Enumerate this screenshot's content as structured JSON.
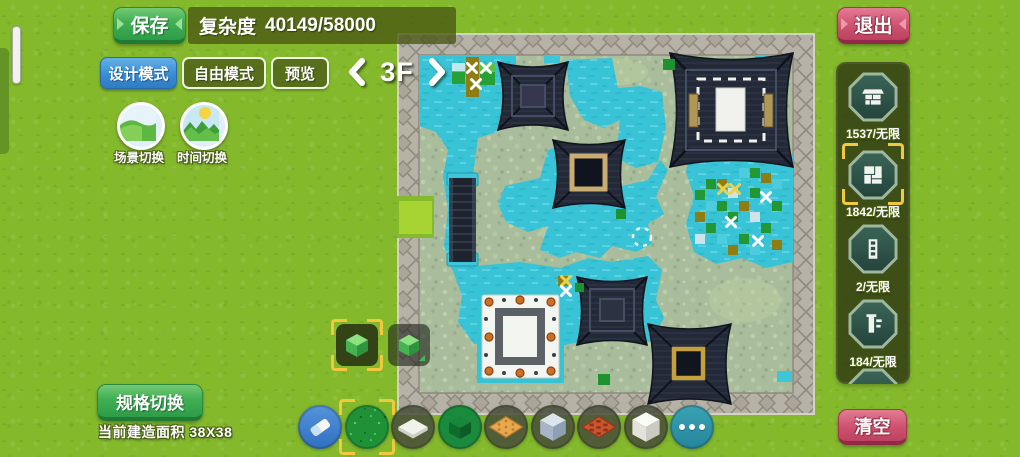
{
  "top_bar": {
    "save_label": "保存",
    "complexity_label": "复杂度",
    "complexity_value": "40149/58000",
    "design_mode_label": "设计模式",
    "free_mode_label": "自由模式",
    "preview_label": "预览",
    "exit_label": "退出"
  },
  "floor_selector": {
    "floor_label": "3F"
  },
  "left_controls": {
    "scene_switch_label": "场景切换",
    "time_switch_label": "时间切换"
  },
  "resource_panel": {
    "items": [
      {
        "icon": "brick-block-icon",
        "count": "1537/无限",
        "selected": false
      },
      {
        "icon": "floor-tile-icon",
        "count": "1842/无限",
        "selected": true
      },
      {
        "icon": "door-icon",
        "count": "2/无限",
        "selected": false
      },
      {
        "icon": "pillar-icon",
        "count": "184/无限",
        "selected": false
      }
    ]
  },
  "bottom_left": {
    "spec_switch_label": "规格切换",
    "area_label": "当前建造面积",
    "area_value": "38X38"
  },
  "clear_label": "清空",
  "block_buttons": [
    {
      "icon": "green-cube-icon",
      "selected": true
    },
    {
      "icon": "green-cube-dropdown-icon",
      "selected": false
    }
  ],
  "toolbar": {
    "items": [
      {
        "icon": "eraser-icon",
        "selected": false
      },
      {
        "icon": "grass-block-icon",
        "selected": true
      },
      {
        "icon": "white-flat-tile-icon",
        "selected": false
      },
      {
        "icon": "green-block-icon",
        "selected": false
      },
      {
        "icon": "wood-pattern-tile-icon",
        "selected": false
      },
      {
        "icon": "stone-cube-icon",
        "selected": false
      },
      {
        "icon": "red-grid-tile-icon",
        "selected": false
      },
      {
        "icon": "white-cube-icon",
        "selected": false
      },
      {
        "icon": "more-icon",
        "selected": false
      }
    ]
  },
  "colors": {
    "grass_bg": "#84b92c",
    "accent_green": "#3fae54",
    "accent_blue": "#3a8cd4",
    "accent_pink": "#cd526f",
    "panel_olive": "#3a4517",
    "water": "#38c3d6",
    "roof": "#232936",
    "selection_yellow": "#f2c93e"
  }
}
